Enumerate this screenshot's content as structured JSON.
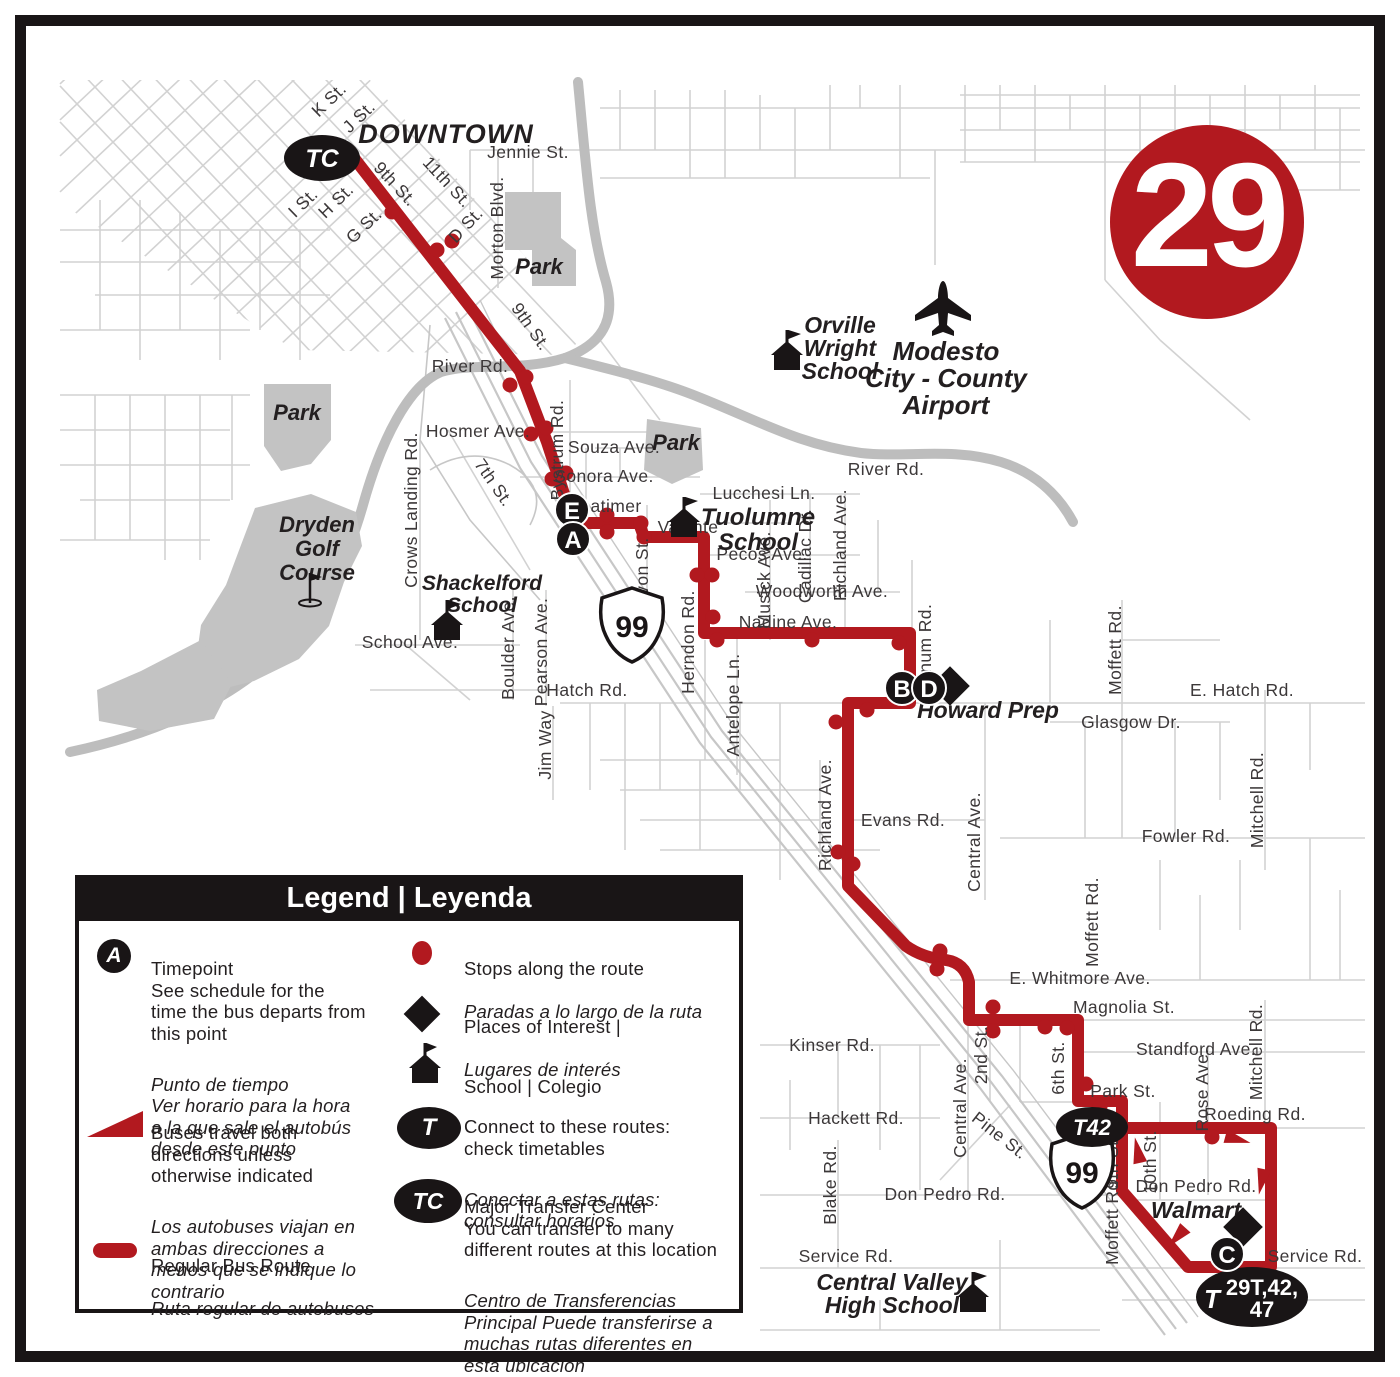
{
  "route_badge": {
    "number": "29"
  },
  "markers": {
    "tc": "TC",
    "t42": "T42",
    "t_prefix": "T",
    "t_multi_line1": "29T,42,",
    "t_multi_line2": "47",
    "highway_shield": "99",
    "timepoints": {
      "a": "A",
      "b": "B",
      "c": "C",
      "d": "D",
      "e": "E"
    }
  },
  "colors": {
    "route_red": "#b2191f",
    "map_gray": "#d2d2d2",
    "feature_gray": "#bdbdbd",
    "dark": "#231f20"
  },
  "labels": {
    "downtown": "DOWNTOWN",
    "k_st": "K St.",
    "j_st": "J St.",
    "i_st": "I St.",
    "h_st": "H St.",
    "g_st": "G St.",
    "d_st": "D St.",
    "ninth_st": "9th St.",
    "eleventh_st": "11th St.",
    "tenth_st": "10th St.",
    "seventh_st": "7th St.",
    "sixth_st": "6th St.",
    "second_st": "2nd St.",
    "jennie": "Jennie St.",
    "morton": "Morton Blvd.",
    "park": "Park",
    "river_rd": "River Rd.",
    "hosmer": "Hosmer Ave.",
    "bystrum": "Bystrum Rd.",
    "souza": "Souza Ave.",
    "sonora": "Sonora Ave.",
    "latimer": "Latimer",
    "valente": "Valente",
    "crows": "Crows Landing Rd.",
    "tuolumne_1": "Tuolumne",
    "tuolumne_2": "School",
    "lucchesi": "Lucchesi Ln.",
    "pecos": "Pecos Ave.",
    "musick": "Musick Ave.",
    "cadillac": "Cadillac Dr.",
    "richland": "Richland Ave.",
    "woodworth": "Woodworth Ave.",
    "nadine": "Nadine Ave.",
    "avon": "Avon St.",
    "herndon": "Herndon Rd.",
    "antelope": "Antelope Ln.",
    "shackelford_1": "Shackelford",
    "shackelford_2": "School",
    "school_ave": "School Ave.",
    "boulder": "Boulder Ave.",
    "pearson": "Pearson Ave.",
    "hatch": "Hatch Rd.",
    "jim_way": "Jim Way",
    "stonum": "Stonum Rd.",
    "howard_prep": "Howard Prep",
    "e_hatch": "E. Hatch Rd.",
    "glasgow": "Glasgow Dr.",
    "moffett": "Moffett Rd.",
    "mitchell": "Mitchell Rd.",
    "fowler": "Fowler Rd.",
    "evans": "Evans Rd.",
    "central_ave": "Central Ave.",
    "whitmore": "E. Whitmore Ave.",
    "magnolia": "Magnolia St.",
    "kinser": "Kinser Rd.",
    "hackett": "Hackett Rd.",
    "pine": "Pine St.",
    "park_st": "Park St.",
    "standford": "Standford Ave.",
    "rose": "Rose Ave.",
    "roeding": "Roeding Rd.",
    "don_pedro": "Don Pedro Rd.",
    "walmart": "Walmart",
    "service": "Service Rd.",
    "blake": "Blake Rd.",
    "cv_1": "Central Valley",
    "cv_2": "High School",
    "orville_1": "Orville",
    "orville_2": "Wright",
    "orville_3": "School",
    "airport_1": "Modesto",
    "airport_2": "City - County",
    "airport_3": "Airport",
    "dryden_1": "Dryden",
    "dryden_2": "Golf",
    "dryden_3": "Course"
  },
  "legend": {
    "title": "Legend | Leyenda",
    "timepoint_icon": "A",
    "timepoint_en": "Timepoint\nSee schedule for the\ntime the bus departs from\nthis point",
    "timepoint_es": "Punto de tiempo\nVer horario para la hora\na la que sale el autobús\ndesde este punto",
    "directions_en": "Buses travel both\ndirections unless\notherwise indicated",
    "directions_es": "Los autobuses viajan en\nambas direcciones a\nmenos que se indique lo\ncontrario",
    "route_en": "Regular Bus Route",
    "route_es": "Ruta regular de autobuses",
    "stops_en": "Stops along the route",
    "stops_es": "Paradas a lo largo de la ruta",
    "poi_en": "Places of Interest |",
    "poi_es": "Lugares de interés",
    "school_en": "School | Colegio",
    "connect_icon": "T",
    "connect_en": "Connect to these routes:\ncheck timetables",
    "connect_es": "Conectar a estas rutas:\nconsultar horarios",
    "transfer_icon": "TC",
    "transfer_en": "Major Transfer Center\nYou can transfer to many\ndifferent routes at this location",
    "transfer_es": "Centro de Transferencias\nPrincipal Puede transferirse a\nmuchas rutas diferentes en\nesta ubicación"
  }
}
